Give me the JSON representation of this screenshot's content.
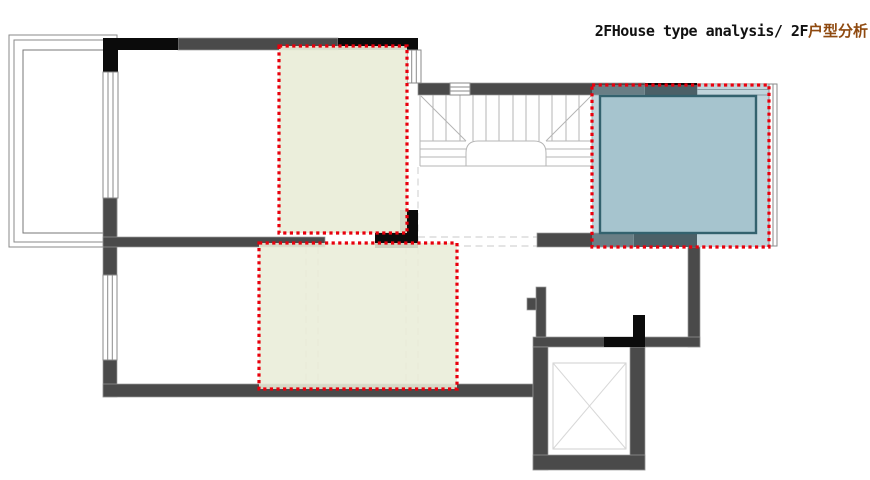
{
  "title": {
    "en": "2FHouse type analysis/ 2F",
    "zh": "户型分析"
  },
  "colors": {
    "title_text": "#111111",
    "title_accent": "#8f4a10",
    "wall_gray": "#4a4a4a",
    "column_black": "#0b0b0b",
    "window_line_gray": "#8a8a8a",
    "stair_line": "#b5b5b5",
    "dashed_guide": "#dcdcdc",
    "highlight_border_red": "#e8000d",
    "highlight_green_fill": "#e9edd8",
    "highlight_blue_fill": "#87afbc",
    "highlight_blue_inner_stroke": "#33626e"
  },
  "highlights": [
    {
      "name": "upper-room-highlight",
      "style": "red-dotted-border",
      "fill": "green"
    },
    {
      "name": "lower-room-highlight",
      "style": "red-dotted-border",
      "fill": "green"
    },
    {
      "name": "right-room-highlight",
      "style": "red-dotted-border",
      "fill": "blue"
    }
  ],
  "plan_symbols": [
    {
      "name": "balcony-window"
    },
    {
      "name": "staircase"
    },
    {
      "name": "elevator-shaft"
    }
  ]
}
